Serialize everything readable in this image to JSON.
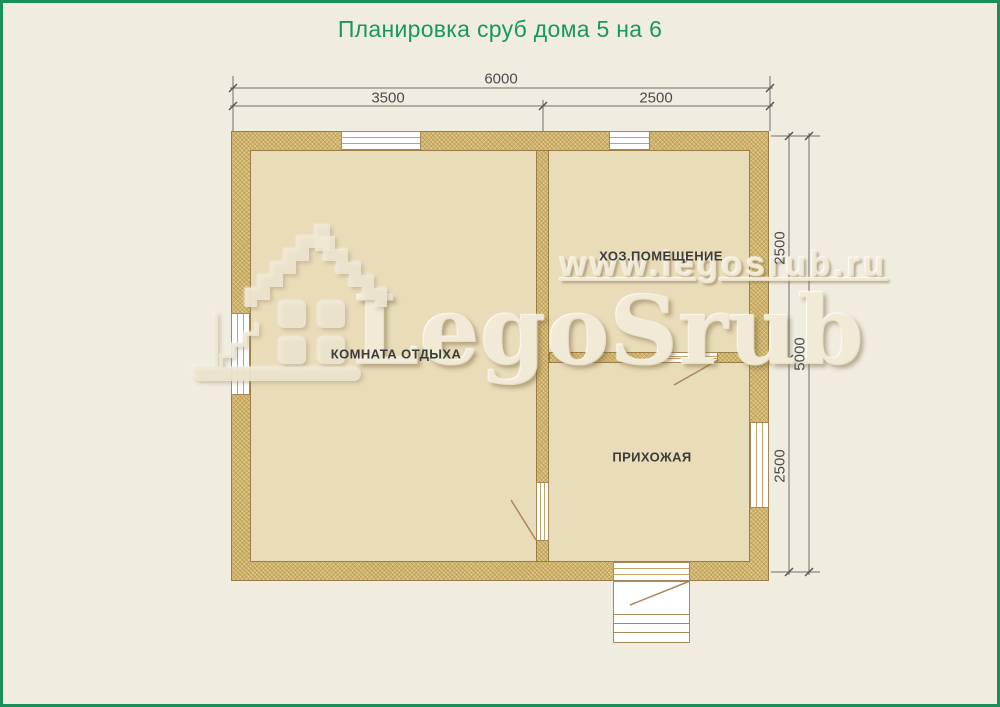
{
  "page": {
    "title": "Планировка сруб дома 5 на 6",
    "colors": {
      "title_green": "#17985e",
      "border_green": "#1a9058",
      "background_cream": "#f0ecdf",
      "wall_fill": "#cfb46e",
      "wall_outline": "#9c7d45",
      "floor_fill": "#e9dcb8",
      "dimension_gray": "#5a5a5a",
      "door_line_brown": "#a9875a"
    }
  },
  "plan": {
    "house_size_meters": "5 на 6",
    "rooms": [
      {
        "name": "rest-room",
        "label": "КОМНАТА ОТДЫХА"
      },
      {
        "name": "utility-room",
        "label": "ХОЗ.ПОМЕЩЕНИЕ"
      },
      {
        "name": "hallway",
        "label": "ПРИХОЖАЯ"
      }
    ],
    "dimensions": {
      "width_total": "6000",
      "width_left": "3500",
      "width_right": "2500",
      "height_total": "5000",
      "height_upper": "2500",
      "height_lower": "2500"
    }
  },
  "watermark": {
    "site_url": "www.legosrub.ru",
    "brand": "LegoSrub",
    "logo": "house-logo"
  }
}
